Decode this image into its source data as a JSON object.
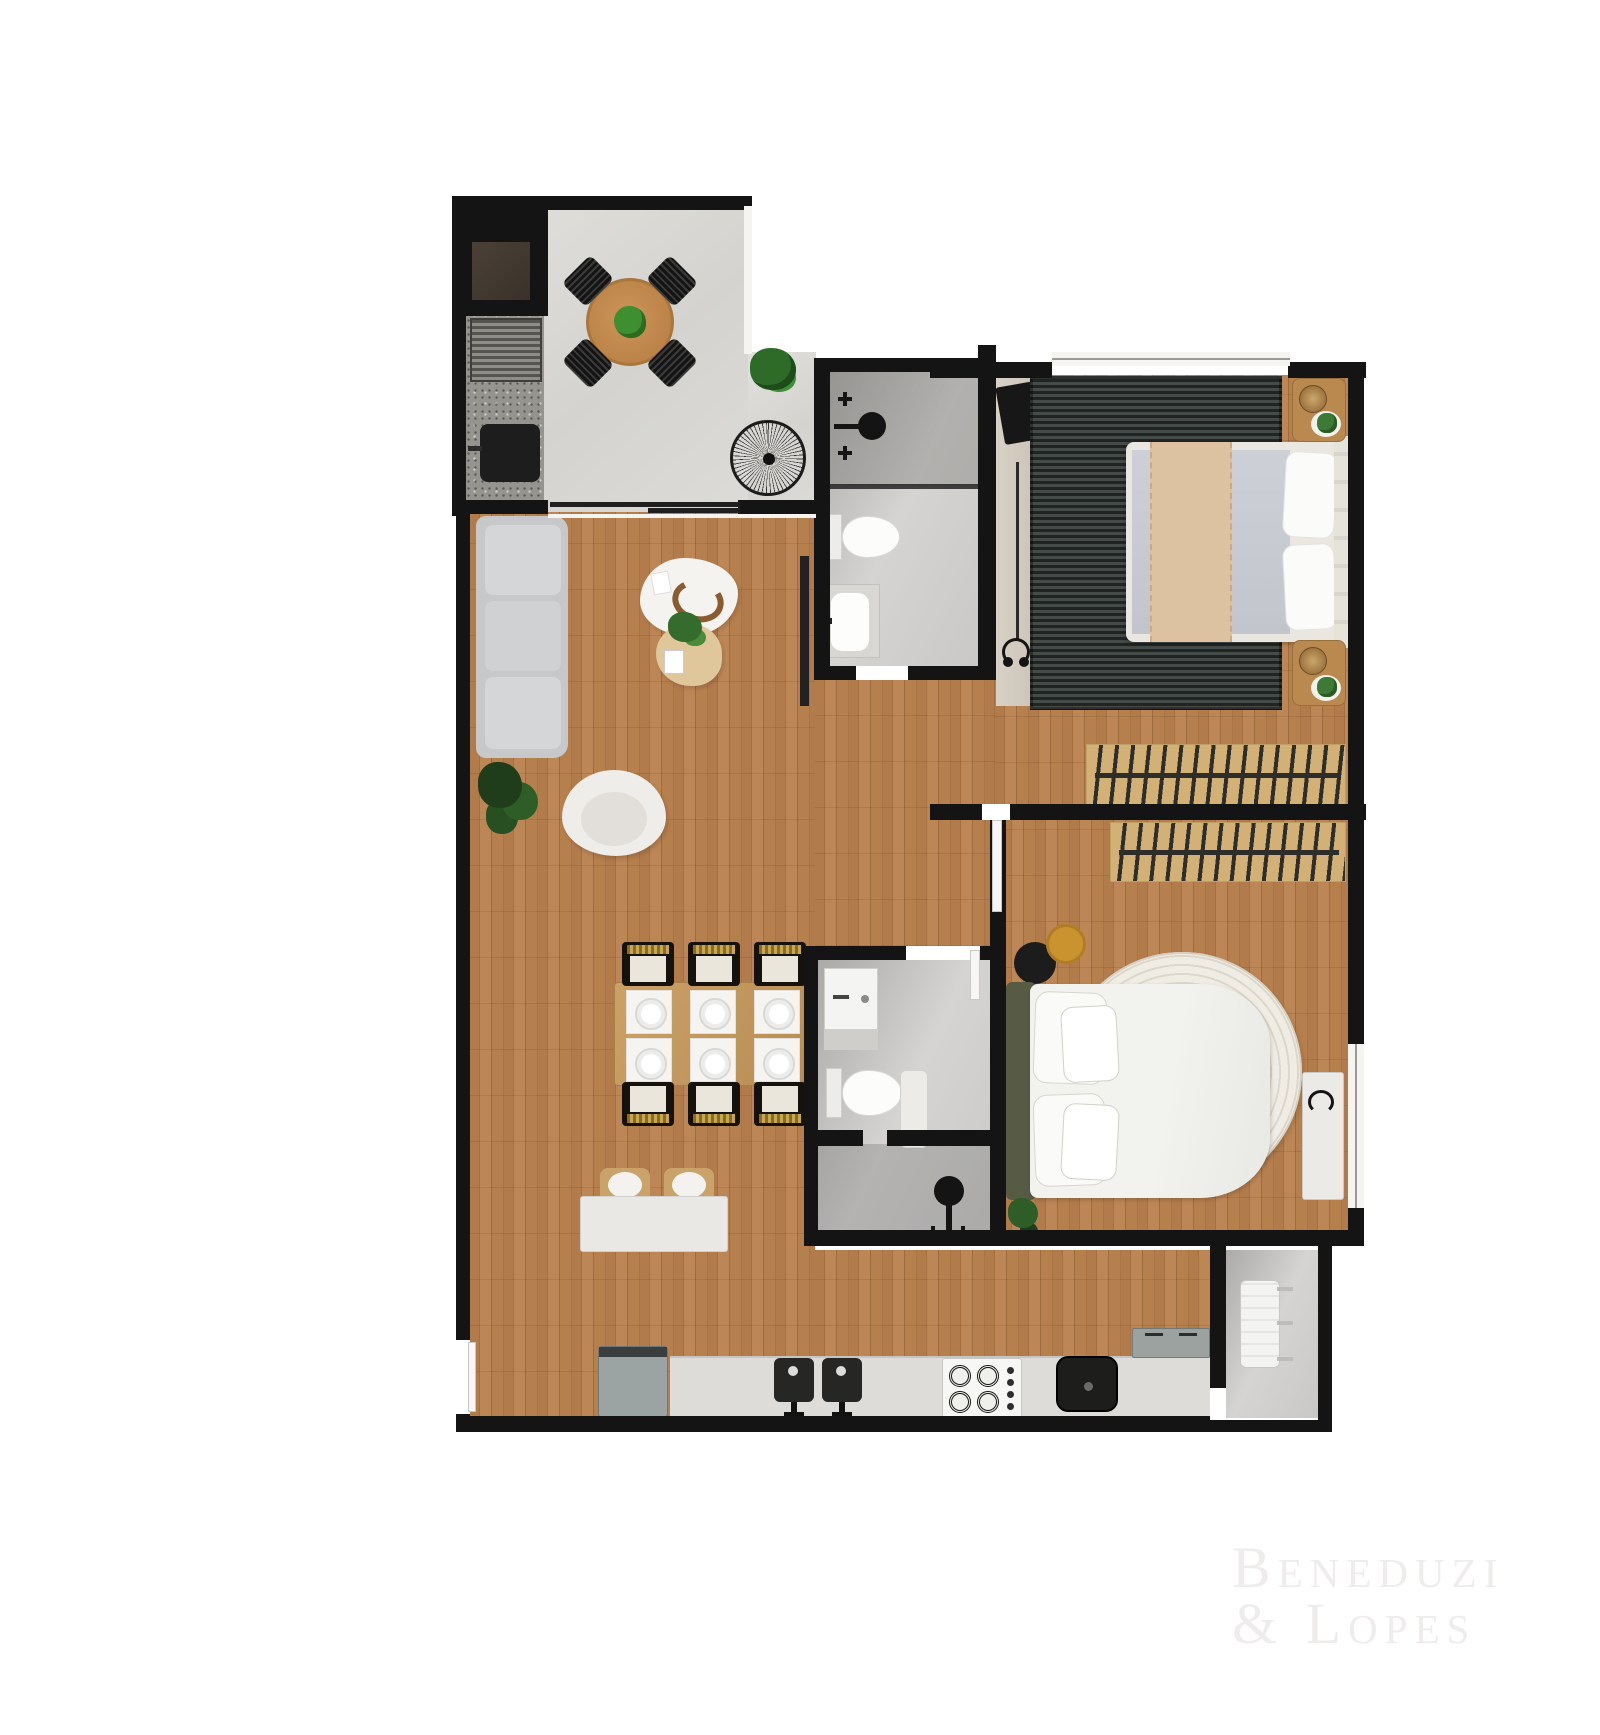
{
  "watermark": {
    "line1": "Beneduzi",
    "line2": "& Lopes"
  },
  "palette": {
    "background": "#ffffff",
    "wall": "#141414",
    "wood_floor": "#b27b4c",
    "balcony_tile": "#d9d8d4",
    "bathroom_tile": "#c9c8c6",
    "granite": "#95948f",
    "rug_dark": "#323735",
    "closet_tan": "#d3b176",
    "round_rug": "#eceadf",
    "plant_green": "#3c7a35",
    "mustard": "#ca9330",
    "throw_beige": "#dcc2a0",
    "olive_headboard": "#575b44",
    "watermark": "#eeedec"
  },
  "plan": {
    "type": "apartment-floor-plan-3d-render",
    "rooms": [
      {
        "name": "balcony-terrace",
        "floor": "light-gray-tile",
        "furniture": [
          "utility-shaft",
          "granite-counter",
          "barbecue-grill",
          "outdoor-sink",
          "round-dining-table",
          "four-black-chairs",
          "table-plant",
          "potted-plant",
          "wire-decor-chair"
        ]
      },
      {
        "name": "living-dining-room",
        "floor": "wood-plank",
        "furniture": [
          "sofa",
          "tv-panel",
          "coffee-table",
          "side-table",
          "floor-plant",
          "armchair",
          "dining-table",
          "six-dining-chairs",
          "plates",
          "breakfast-bar",
          "two-stools"
        ]
      },
      {
        "name": "bathroom-1",
        "floor": "gray-tile",
        "furniture": [
          "shower",
          "shower-handles",
          "glass-partition",
          "toilet",
          "vanity-sink"
        ]
      },
      {
        "name": "bedroom-1-suite",
        "floor": "wood-plank",
        "furniture": [
          "desk",
          "laptop",
          "desk-chair",
          "headphones",
          "striped-dark-rug",
          "double-bed",
          "beige-throw",
          "pillows",
          "nightstand-with-plant-top",
          "nightstand-with-plant-bottom",
          "open-closet-rack",
          "window"
        ]
      },
      {
        "name": "bedroom-2",
        "floor": "wood-plank",
        "furniture": [
          "open-closet-rack",
          "black-ottoman",
          "mustard-side-table",
          "round-white-rug",
          "double-bed-olive-headboard",
          "pillows",
          "bench-with-headphones",
          "floor-plant",
          "window"
        ]
      },
      {
        "name": "bathroom-2",
        "floor": "gray-tile",
        "furniture": [
          "vanity-cabinet",
          "toilet",
          "shower",
          "shower-handles",
          "shelf"
        ]
      },
      {
        "name": "kitchen",
        "floor": "wood-plank",
        "furniture": [
          "refrigerator",
          "counter",
          "double-sink-with-faucets",
          "gas-cooktop-4-burners",
          "black-prep-sink",
          "gray-sideboard"
        ]
      },
      {
        "name": "laundry-service-area",
        "floor": "gray-tile",
        "furniture": [
          "drying-rack"
        ]
      }
    ]
  }
}
